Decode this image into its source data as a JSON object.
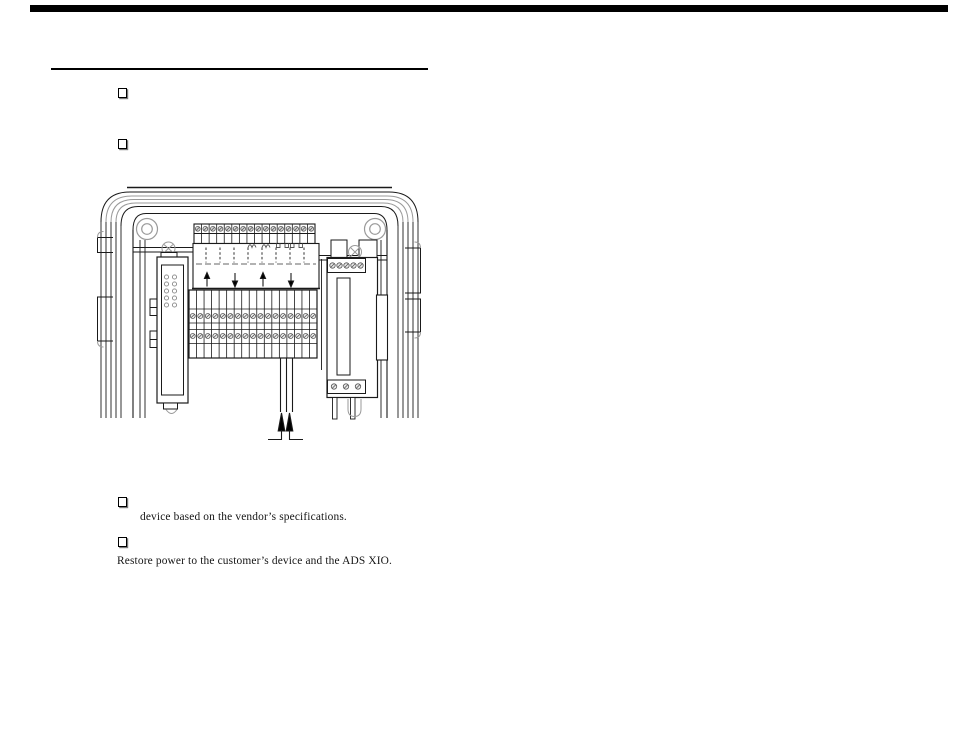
{
  "page": {
    "background": "#ffffff",
    "ink": "#1a1a1a",
    "muted": "#9a9a9a"
  },
  "artifacts": {
    "top_scan_bar": true
  },
  "checklist": {
    "upper_items": [
      {
        "label": ""
      },
      {
        "label": ""
      }
    ],
    "continuation": "device based on the vendor’s specifications.",
    "lower_item_label": "",
    "closing_line": "Restore power to the customer’s device and the ADS XIO."
  },
  "diagram": {
    "top_terminal_count": 16,
    "block_columns": 17,
    "block_screw_rows": 2,
    "led_rows": 5,
    "led_cols": 2,
    "right_top_screws": 5,
    "right_bottom_screws": 3,
    "dashed_line_count": 8,
    "panel_arrows": [
      "up",
      "down",
      "up",
      "down"
    ],
    "cable_entry_arrows": 2
  }
}
